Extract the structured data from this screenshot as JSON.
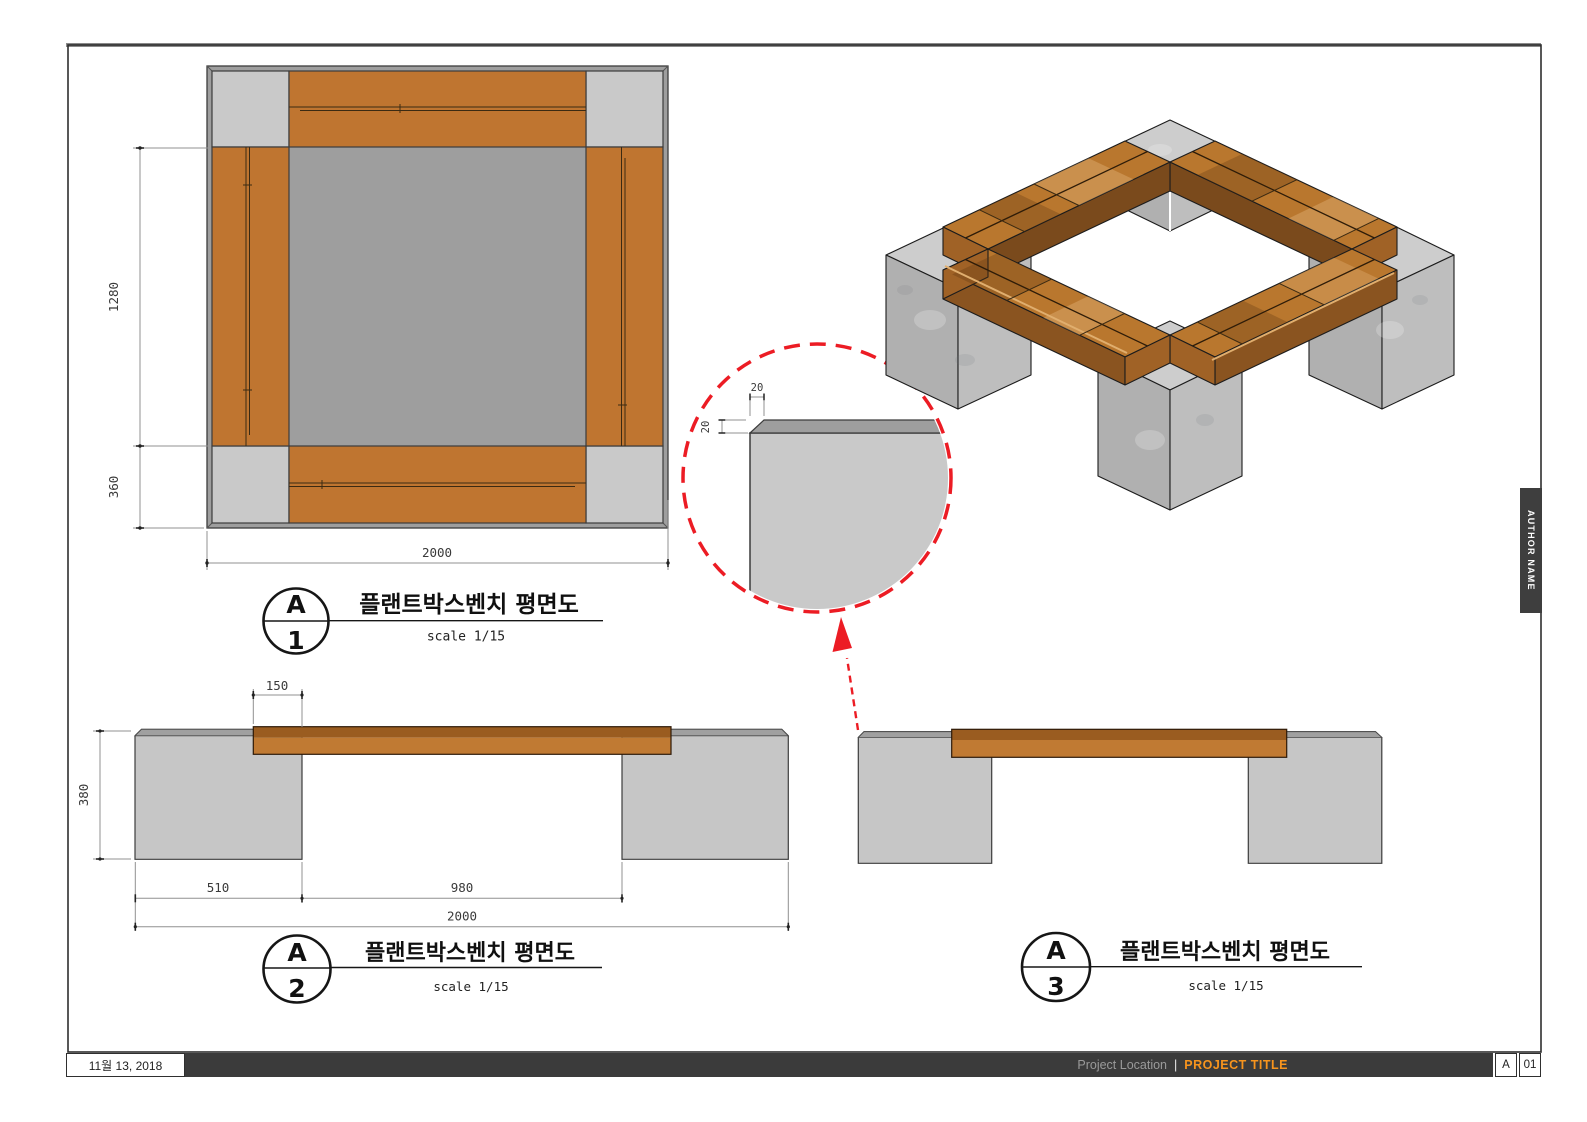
{
  "sheet": {
    "titlebar": {
      "date": "11월 13, 2018",
      "project_location": "Project Location",
      "separator": "|",
      "project_title": "PROJECT TITLE",
      "sheet_letter": "A",
      "sheet_number": "01"
    },
    "author_tab_label": "AUTHOR NAME"
  },
  "views": {
    "plan": {
      "marker_letter": "A",
      "marker_number": "1",
      "title": "플랜트박스벤치 평면도",
      "scale_label": "scale 1/15",
      "dims": {
        "inner_height": "1280",
        "corner_block": "360",
        "overall_width": "2000"
      }
    },
    "front_elevation": {
      "marker_letter": "A",
      "marker_number": "2",
      "title": "플랜트박스벤치 평면도",
      "scale_label": "scale 1/15",
      "dims": {
        "seat_overhang": "150",
        "bench_height": "380",
        "leg_block_width": "510",
        "clear_span": "980",
        "overall_width": "2000"
      }
    },
    "side_elevation": {
      "marker_letter": "A",
      "marker_number": "3",
      "title": "플랜트박스벤치 평면도",
      "scale_label": "scale 1/15"
    },
    "corner_detail": {
      "chamfer_width": "20",
      "chamfer_depth": "20"
    }
  },
  "colors": {
    "wood": "#bf7530",
    "wood_dark": "#9a5c20",
    "wood_3d_top": "#b9772e",
    "concrete": "#c8c8c8",
    "concrete_chamfer": "#9e9e9e",
    "detail_red": "#ec1c24",
    "accent_orange": "#f7941d",
    "titlebar_dark": "#3b3b3b"
  }
}
